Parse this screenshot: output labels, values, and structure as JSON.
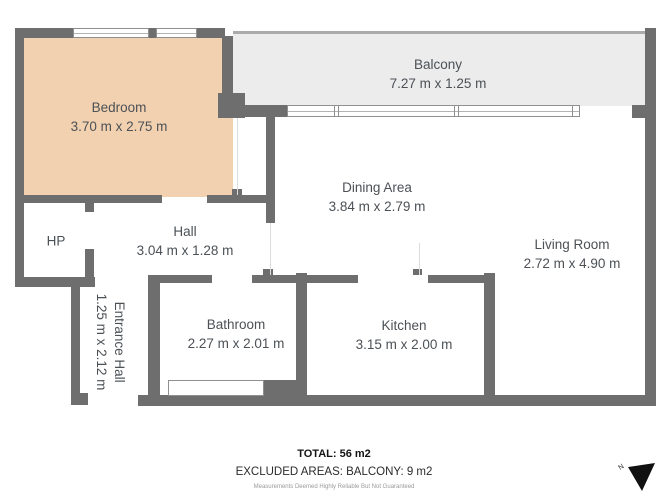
{
  "rooms": {
    "bedroom": {
      "name": "Bedroom",
      "dims": "3.70 m x 2.75 m"
    },
    "balcony": {
      "name": "Balcony",
      "dims": "7.27 m x 1.25 m"
    },
    "dining": {
      "name": "Dining Area",
      "dims": "3.84 m x 2.79 m"
    },
    "living": {
      "name": "Living Room",
      "dims": "2.72 m x 4.90 m"
    },
    "hall": {
      "name": "Hall",
      "dims": "3.04 m x 1.28 m"
    },
    "hp": {
      "name": "HP"
    },
    "entrance": {
      "name": "Entrance Hall",
      "dims": "1.25 m x 2.12 m"
    },
    "bathroom": {
      "name": "Bathroom",
      "dims": "2.27 m x 2.01 m"
    },
    "kitchen": {
      "name": "Kitchen",
      "dims": "3.15 m x 2.00 m"
    }
  },
  "footer": {
    "total": "TOTAL: 56 m2",
    "excluded": "EXCLUDED AREAS: BALCONY: 9 m2",
    "disclaimer": "Measurements Deemed Highly Reliable But Not Guaranteed"
  },
  "compass": {
    "north_label": "N"
  },
  "colors": {
    "wall": "#6e6e6e",
    "bedroom_fill": "#f2d1b0",
    "balcony_fill": "#ececec",
    "label_text": "#4c5156"
  }
}
